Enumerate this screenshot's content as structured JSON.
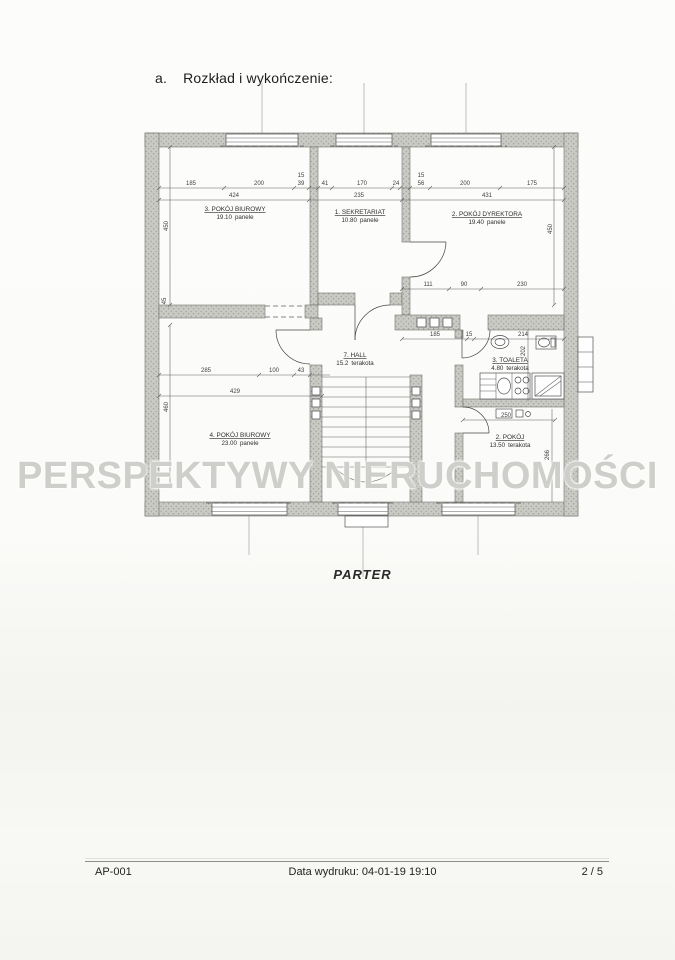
{
  "page": {
    "heading_index": "a.",
    "heading_text": "Rozkład i wykończenie:",
    "caption": "PARTER"
  },
  "watermark": {
    "text": "PERSPEKTYWY NIERUCHOMOŚCI",
    "color": "#c6c6c2"
  },
  "footer": {
    "doc_id": "AP-001",
    "print_info": "Data wydruku: 04-01-19 19:10",
    "page_num": "2 / 5"
  },
  "plan": {
    "wall_color": "#c7c7c1",
    "rooms": [
      {
        "name": "3. POKÓJ BIUROWY",
        "area": "19.10",
        "finish": "panele"
      },
      {
        "name": "1. SEKRETARIAT",
        "area": "10.80",
        "finish": "panele"
      },
      {
        "name": "2. POKÓJ DYREKTORA",
        "area": "19.40",
        "finish": "panele"
      },
      {
        "name": "7. HALL",
        "area": "15.2",
        "finish": "terakota"
      },
      {
        "name": "3. TOALETA",
        "area": "4.80",
        "finish": "terakota"
      },
      {
        "name": "4. POKÓJ BIUROWY",
        "area": "23.00",
        "finish": "panele"
      },
      {
        "name": "2. POKÓJ",
        "area": "13.50",
        "finish": "terakota"
      }
    ],
    "dims": [
      "185",
      "200",
      "15",
      "39",
      "41",
      "170",
      "24",
      "15",
      "56",
      "200",
      "175",
      "424",
      "235",
      "431",
      "450",
      "45",
      "460",
      "450",
      "111",
      "90",
      "230",
      "185",
      "15",
      "214",
      "202",
      "285",
      "100",
      "43",
      "429",
      "250",
      "266"
    ]
  }
}
